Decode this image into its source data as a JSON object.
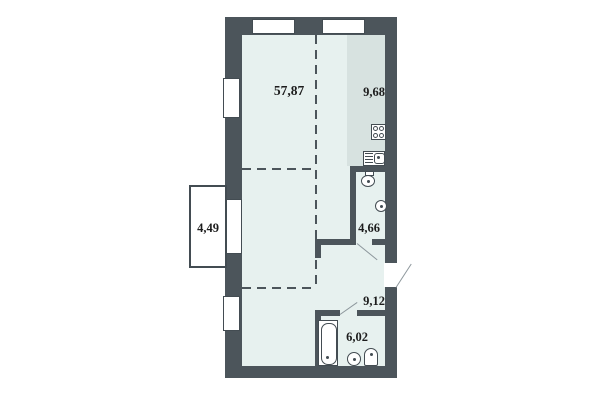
{
  "plan": {
    "rooms": [
      {
        "id": "living-room",
        "area": "57,87"
      },
      {
        "id": "kitchen",
        "area": "9,68"
      },
      {
        "id": "balcony",
        "area": "4,49"
      },
      {
        "id": "wc",
        "area": "4,66"
      },
      {
        "id": "hallway",
        "area": "9,12"
      },
      {
        "id": "bathroom",
        "area": "6,02"
      }
    ],
    "colors": {
      "wall": "#4c555b",
      "outline": "#434c52",
      "room_fill": "#e7f1ef",
      "kitchen_fill": "#d7e2e0",
      "background": "#ffffff",
      "label_text": "#1c1c1c",
      "door_line": "#8d979c"
    }
  }
}
